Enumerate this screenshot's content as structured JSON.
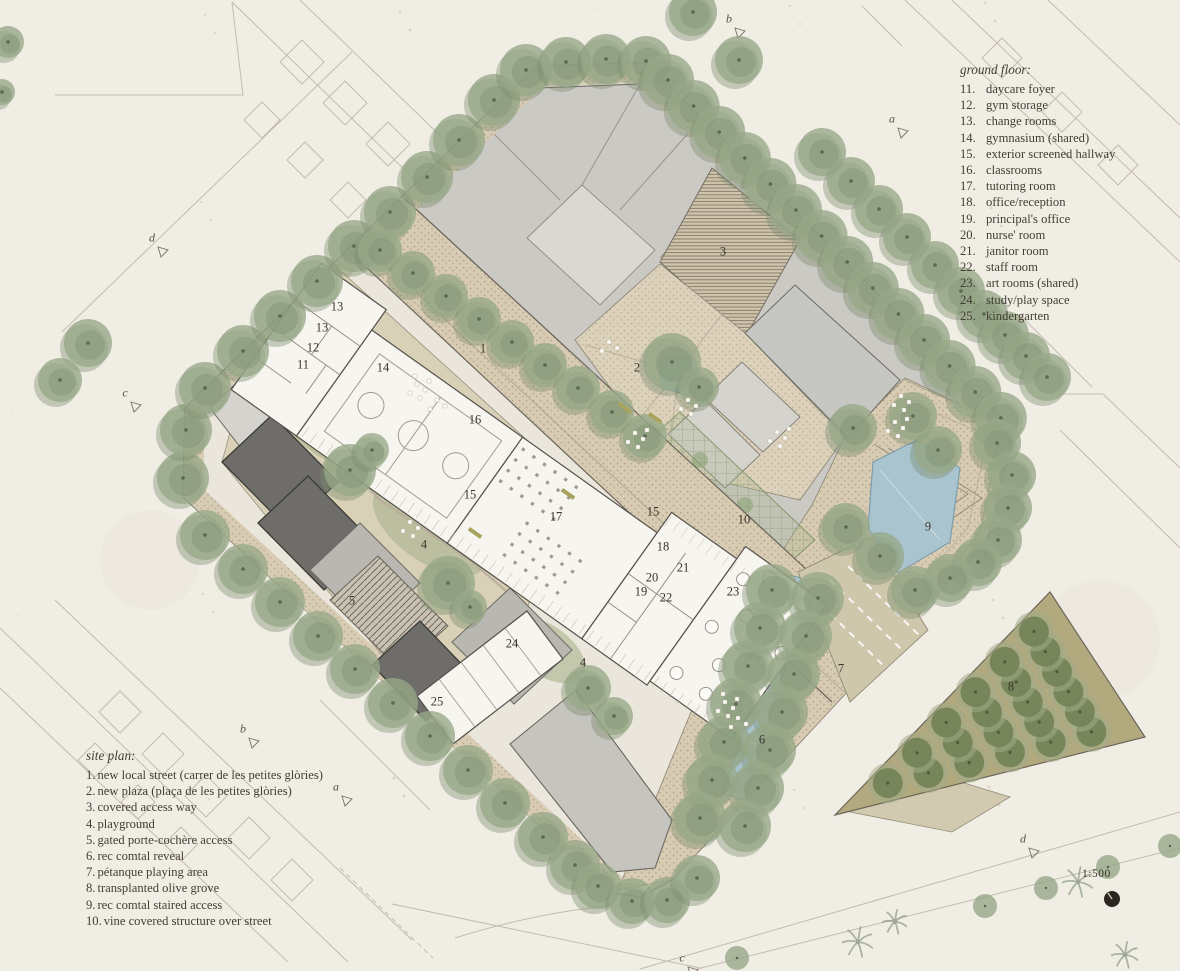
{
  "legend_ground_floor": {
    "title": "ground floor:",
    "items": [
      {
        "num": "11.",
        "label": "daycare foyer"
      },
      {
        "num": "12.",
        "label": "gym storage"
      },
      {
        "num": "13.",
        "label": "change rooms"
      },
      {
        "num": "14.",
        "label": "gymnasium (shared)"
      },
      {
        "num": "15.",
        "label": "exterior screened hallway"
      },
      {
        "num": "16.",
        "label": "classrooms"
      },
      {
        "num": "17.",
        "label": "tutoring room"
      },
      {
        "num": "18.",
        "label": "office/reception"
      },
      {
        "num": "19.",
        "label": "principal's office"
      },
      {
        "num": "20.",
        "label": "nurse' room"
      },
      {
        "num": "21.",
        "label": "janitor room"
      },
      {
        "num": "22.",
        "label": "staff room"
      },
      {
        "num": "23.",
        "label": "art rooms (shared)"
      },
      {
        "num": "24.",
        "label": "study/play space"
      },
      {
        "num": "25.",
        "label": "kindergarten"
      }
    ]
  },
  "legend_site_plan": {
    "title": "site plan:",
    "items": [
      {
        "num": "1.",
        "label": "new local street (carrer de les petites glòries)"
      },
      {
        "num": "2.",
        "label": "new plaza (plaça de les petites glòries)"
      },
      {
        "num": "3.",
        "label": "covered access way"
      },
      {
        "num": "4.",
        "label": "playground"
      },
      {
        "num": "5.",
        "label": "gated porte-cochère access"
      },
      {
        "num": "6.",
        "label": "rec comtal reveal"
      },
      {
        "num": "7.",
        "label": "pétanque playing area"
      },
      {
        "num": "8.",
        "label": "transplanted olive grove"
      },
      {
        "num": "9.",
        "label": "rec comtal staired access"
      },
      {
        "num": "10.",
        "label": "vine covered structure over street"
      }
    ]
  },
  "scale": {
    "label": "1:500"
  },
  "plan_labels": [
    {
      "text": "1",
      "x": 483,
      "y": 349
    },
    {
      "text": "2",
      "x": 637,
      "y": 368
    },
    {
      "text": "3",
      "x": 723,
      "y": 252
    },
    {
      "text": "4",
      "x": 424,
      "y": 545
    },
    {
      "text": "4",
      "x": 583,
      "y": 663
    },
    {
      "text": "5",
      "x": 352,
      "y": 601
    },
    {
      "text": "6",
      "x": 762,
      "y": 740
    },
    {
      "text": "7",
      "x": 841,
      "y": 669
    },
    {
      "text": "8",
      "x": 1011,
      "y": 687
    },
    {
      "text": "9",
      "x": 928,
      "y": 527
    },
    {
      "text": "10",
      "x": 744,
      "y": 520
    },
    {
      "text": "11",
      "x": 303,
      "y": 365
    },
    {
      "text": "12",
      "x": 313,
      "y": 348
    },
    {
      "text": "13",
      "x": 337,
      "y": 307
    },
    {
      "text": "13",
      "x": 322,
      "y": 328
    },
    {
      "text": "14",
      "x": 383,
      "y": 368
    },
    {
      "text": "15",
      "x": 470,
      "y": 495
    },
    {
      "text": "15",
      "x": 653,
      "y": 512
    },
    {
      "text": "16",
      "x": 475,
      "y": 420
    },
    {
      "text": "17",
      "x": 556,
      "y": 517
    },
    {
      "text": "18",
      "x": 663,
      "y": 547
    },
    {
      "text": "19",
      "x": 641,
      "y": 592
    },
    {
      "text": "20",
      "x": 652,
      "y": 578
    },
    {
      "text": "21",
      "x": 683,
      "y": 568
    },
    {
      "text": "22",
      "x": 666,
      "y": 598
    },
    {
      "text": "23",
      "x": 733,
      "y": 592
    },
    {
      "text": "24",
      "x": 512,
      "y": 644
    },
    {
      "text": "25",
      "x": 437,
      "y": 702
    }
  ],
  "section_markers": [
    {
      "text": "a",
      "x": 892,
      "y": 119
    },
    {
      "text": "a",
      "x": 336,
      "y": 787
    },
    {
      "text": "b",
      "x": 729,
      "y": 19
    },
    {
      "text": "b",
      "x": 243,
      "y": 729
    },
    {
      "text": "c",
      "x": 125,
      "y": 393
    },
    {
      "text": "c",
      "x": 682,
      "y": 958
    },
    {
      "text": "d",
      "x": 152,
      "y": 238
    },
    {
      "text": "d",
      "x": 1023,
      "y": 839
    }
  ],
  "colors": {
    "paper": "#f0ede5",
    "tree": "#97a888",
    "tree_shadow": "#7a8d6d",
    "water": "#a9c4cf",
    "paving": "#d7cbb3",
    "plaza": "#dcd2bc",
    "gray_building": "#cbc9c4",
    "dark_building": "#6e6d69",
    "school_white": "#f7f5ef",
    "olive_grove": "#b2a97e",
    "olive_tree": "#748457",
    "vine": "#7d9363",
    "text": "#3e3931"
  }
}
